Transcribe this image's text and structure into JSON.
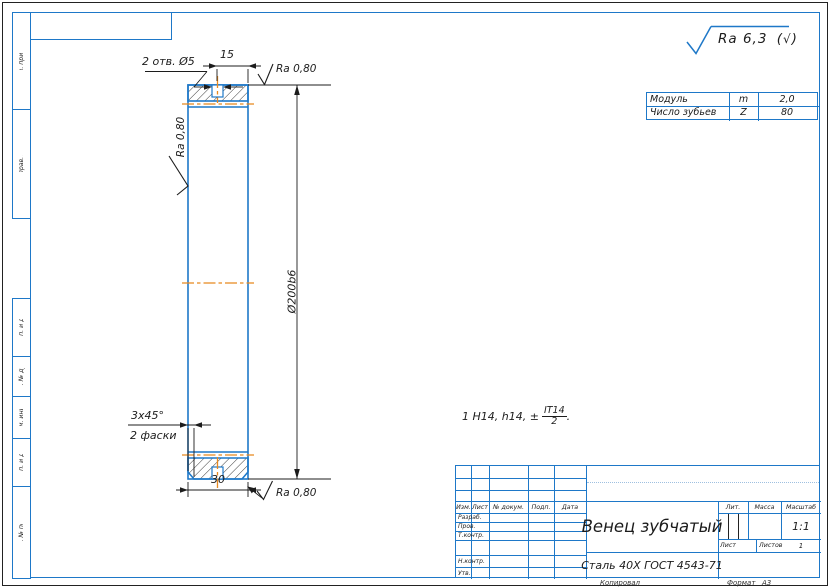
{
  "colors": {
    "line_blue": "#1e78c8",
    "centerline_orange": "#e8891f"
  },
  "margins": {
    "top_labels": [
      "Перв. примен.",
      "Справ. №"
    ],
    "bottom_labels": [
      "Подп. и дата",
      "Инв. № дубл.",
      "Взам. инв. №",
      "Подп. и дата",
      "Инв. № подл."
    ]
  },
  "roughness": {
    "general_value": "Ra 6,3",
    "paren_open": "(",
    "check_glyph": "√",
    "paren_close": ")",
    "local_top": "Ra 0,80",
    "local_left": "Ra 0,80",
    "local_bottom": "Ra 0,80"
  },
  "dims": {
    "holes_note": "2 отв. Ø5",
    "slot_width": "15",
    "outer_diameter": "Ø200b6",
    "chamfer": "3x45°",
    "chamfer_count": "2 фаски",
    "rim_width": "30"
  },
  "notes": {
    "tolerance_prefix": "1 H14, h14, ±",
    "tolerance_num": "IT14",
    "tolerance_den": "2",
    "tolerance_suffix": "."
  },
  "param_table": {
    "rows": [
      {
        "label": "Модуль",
        "symbol": "m",
        "value": "2,0"
      },
      {
        "label": "Число зубьев",
        "symbol": "Z",
        "value": "80"
      }
    ]
  },
  "title_block": {
    "header_cols": [
      "Изм.",
      "Лист",
      "№ докум.",
      "Подп.",
      "Дата"
    ],
    "role_rows": [
      "Разраб.",
      "Пров.",
      "Т.контр.",
      "",
      "Н.контр.",
      "Утв."
    ],
    "part_name": "Венец зубчатый",
    "material": "Сталь 40Х ГОСТ 4543-71",
    "lit_label": "Лит.",
    "mass_label": "Масса",
    "scale_label": "Масштаб",
    "scale_value": "1:1",
    "sheet_label": "Лист",
    "sheets_label": "Листов",
    "sheets_value": "1"
  },
  "footer": {
    "copied": "Копировал",
    "format_label": "Формат",
    "format_value": "А3"
  }
}
